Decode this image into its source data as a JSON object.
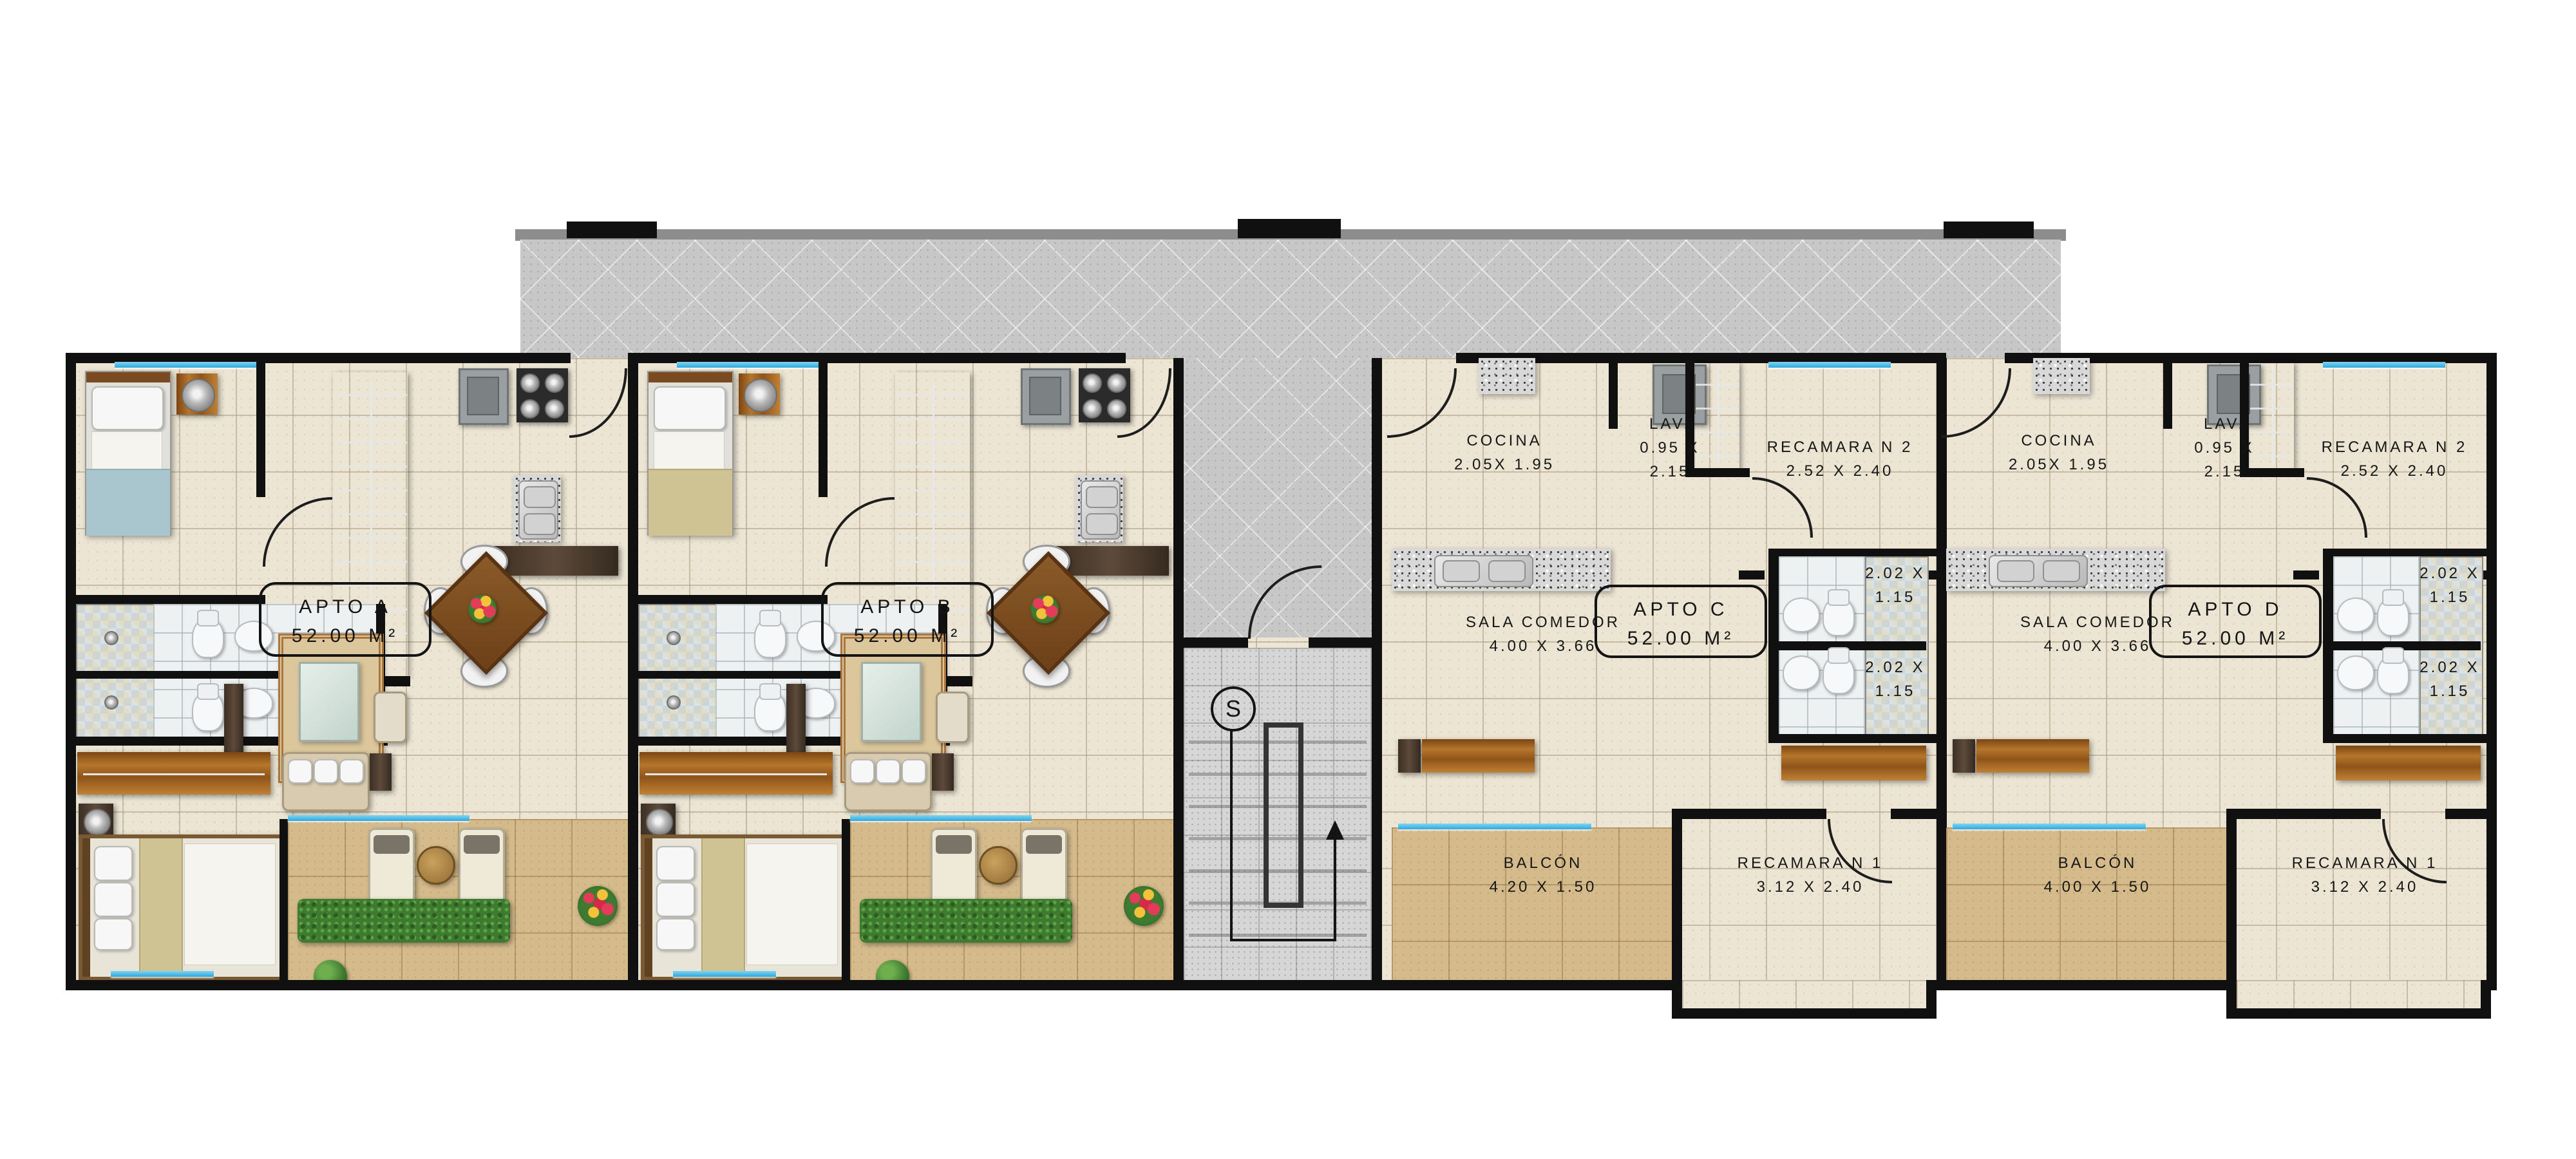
{
  "plan": {
    "title": "Planta tipo - 4 apartamentos",
    "stair_label": "S",
    "colors": {
      "wall": "#101010",
      "floor_tile": "#ece5d4",
      "balcony_tile": "#d5bb8c",
      "corridor_floor": "#c7c7c7",
      "window_glass": "#2fa8dd"
    },
    "units": [
      {
        "name": "APTO A",
        "area": "52.00 M²"
      },
      {
        "name": "APTO B",
        "area": "52.00 M²"
      },
      {
        "name": "APTO C",
        "area": "52.00 M²",
        "rooms": {
          "cocina": {
            "name": "COCINA",
            "dims": "2.05X 1.95"
          },
          "lav": {
            "name": "LAV.",
            "dims": "0.95 X 2.15"
          },
          "recamara2": {
            "name": "RECAMARA N 2",
            "dims": "2.52 X 2.40"
          },
          "sala": {
            "name": "SALA COMEDOR",
            "dims": "4.00 X 3.66"
          },
          "bano1": {
            "dims": "2.02 X 1.15"
          },
          "bano2": {
            "dims": "2.02 X 1.15"
          },
          "balcon": {
            "name": "BALCÓN",
            "dims": "4.20 X 1.50"
          },
          "recamara1": {
            "name": "RECAMARA N 1",
            "dims": "3.12 X 2.40"
          }
        }
      },
      {
        "name": "APTO D",
        "area": "52.00 M²",
        "rooms": {
          "cocina": {
            "name": "COCINA",
            "dims": "2.05X 1.95"
          },
          "lav": {
            "name": "LAV.",
            "dims": "0.95 X 2.15"
          },
          "recamara2": {
            "name": "RECAMARA N 2",
            "dims": "2.52 X 2.40"
          },
          "sala": {
            "name": "SALA COMEDOR",
            "dims": "4.00 X 3.66"
          },
          "bano1": {
            "dims": "2.02 X 1.15"
          },
          "bano2": {
            "dims": "2.02 X 1.15"
          },
          "balcon": {
            "name": "BALCÓN",
            "dims": "4.00 X 1.50"
          },
          "recamara1": {
            "name": "RECAMARA N 1",
            "dims": "3.12 X 2.40"
          }
        }
      }
    ]
  }
}
